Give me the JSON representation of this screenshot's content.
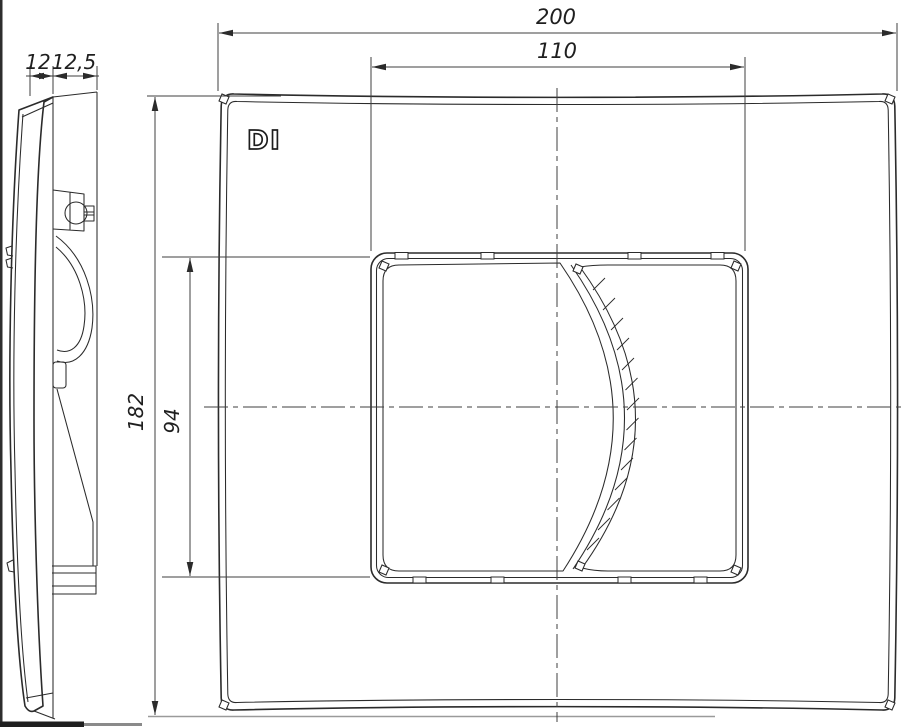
{
  "drawing": {
    "type": "technical-drawing",
    "subject": "dual-flush wall plate, side profile and front view",
    "logo": "DI",
    "colors": {
      "background": "#ffffff",
      "object_line": "#2b2b2b",
      "dimension_line": "#3f3f3f",
      "baseline": "#9a9a9a"
    },
    "dimensions": {
      "plate_width": "200",
      "button_window_width": "110",
      "plate_height": "182",
      "button_window_height": "94",
      "profile_front_thickness": "12",
      "profile_mount_depth": "12,5"
    }
  }
}
